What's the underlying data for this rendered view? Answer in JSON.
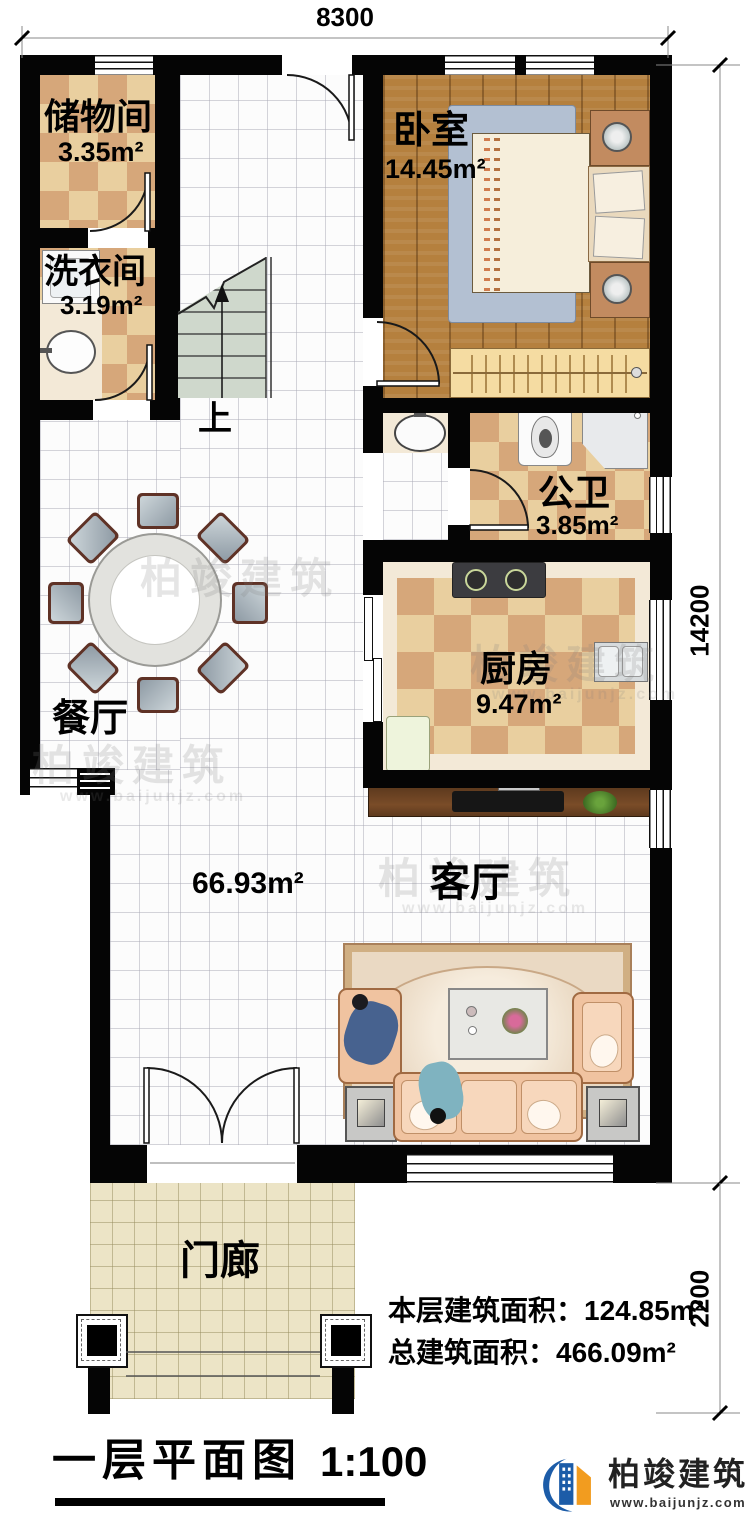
{
  "dimensions": {
    "top": "8300",
    "right": "14200",
    "right_lower": "2200"
  },
  "rooms": {
    "storage": {
      "name": "储物间",
      "area": "3.35m²"
    },
    "laundry": {
      "name": "洗衣间",
      "area": "3.19m²"
    },
    "bedroom": {
      "name": "卧室",
      "area": "14.45m²"
    },
    "bathroom": {
      "name": "公卫",
      "area": "3.85m²"
    },
    "kitchen": {
      "name": "厨房",
      "area": "9.47m²"
    },
    "dining": {
      "name": "餐厅"
    },
    "living": {
      "name": "客厅"
    },
    "porch": {
      "name": "门廊"
    },
    "open_area": "66.93m²",
    "stairs_up": "上"
  },
  "summary": {
    "floor_area": "本层建筑面积：124.85m²",
    "total_area": "总建筑面积：466.09m²"
  },
  "title": {
    "text": "一层平面图",
    "scale": "1:100"
  },
  "brand": {
    "name": "柏竣建筑",
    "url": "www.baijunjz.com"
  }
}
